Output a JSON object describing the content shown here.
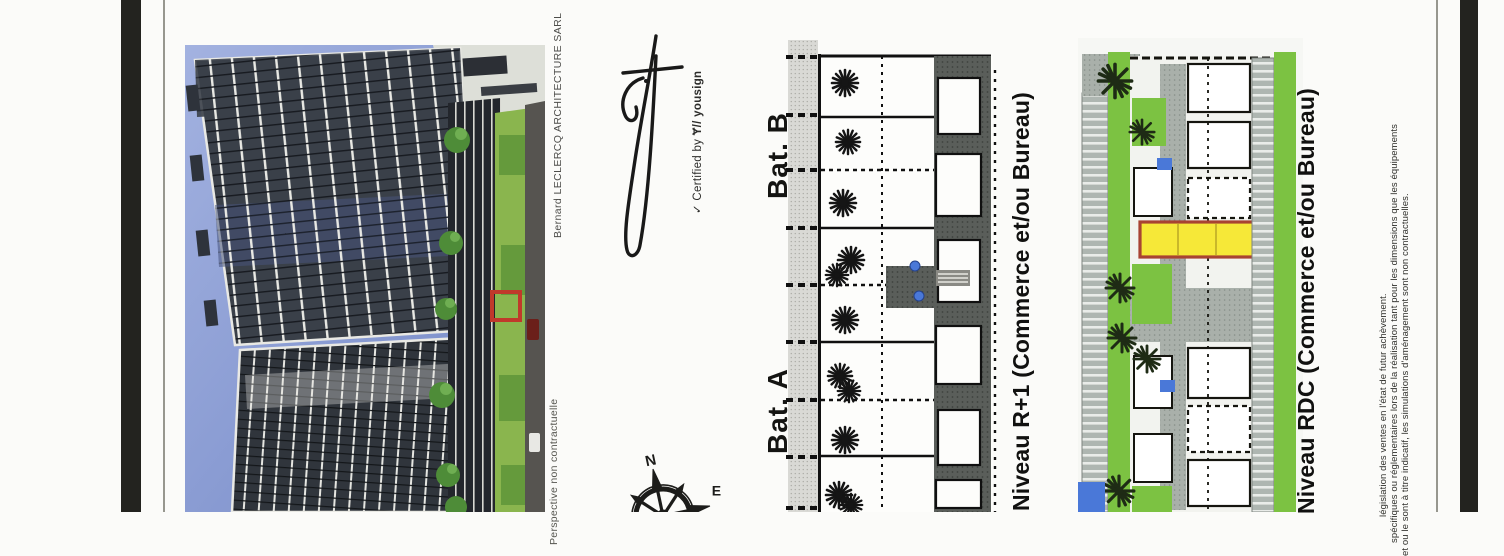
{
  "perspective": {
    "credit": "Bernard LECLERCQ ARCHITECTURE SARL",
    "caption": "Perspective non contractuelle",
    "annotation_color": "#c0392b",
    "sky_color": "#8a9cd3"
  },
  "signature": {
    "check": "✓",
    "certified_label": "Certified by",
    "brand_logo": "Ɏ//",
    "brand": "yousign"
  },
  "plans": {
    "r1": {
      "label_top": "Bat. B",
      "label_bottom": "Bat. A",
      "caption": "Niveau R+1 (Commerce et/ou Bureau)"
    },
    "rdc": {
      "caption": "Niveau RDC (Commerce et/ou Bureau)",
      "highlight_fill": "#f6e838",
      "highlight_outline": "#a84332",
      "landscape_green": "#7cc242",
      "water_blue": "#4a78d8"
    }
  },
  "compass": {
    "north": "N",
    "east": "E"
  },
  "disclaimer": {
    "line1": "législation des ventes en l'état de futur achèvement.",
    "line2": "spécifiques ou réglementaires lors de la réalisation tant pour les dimensions que les équipements",
    "line3": "et ou le sont à titre indicatif, les simulations d'aménagement sont non contractuelles."
  }
}
